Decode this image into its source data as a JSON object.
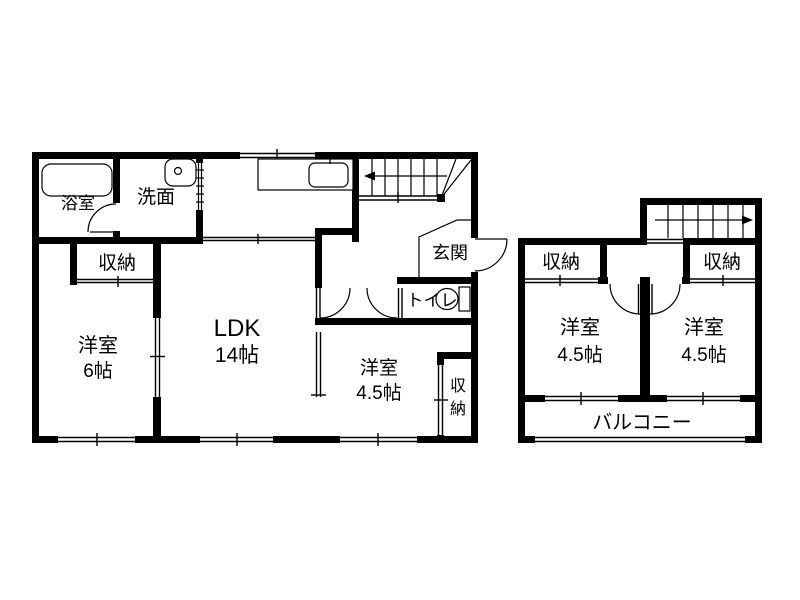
{
  "doc": {
    "type": "floor-plan",
    "floors_shown": 2
  },
  "colors": {
    "wall": "#000000",
    "background": "#ffffff",
    "text": "#000000"
  },
  "f1": {
    "bath": "浴室",
    "wash": "洗面",
    "closet_nw": "収納",
    "bed6_name": "洋室",
    "bed6_size": "6帖",
    "ldk_name": "LDK",
    "ldk_size": "14帖",
    "entrance": "玄関",
    "toilet": "トイレ",
    "bed45_name": "洋室",
    "bed45_size": "4.5帖",
    "closet_se_1": "収",
    "closet_se_2": "納"
  },
  "f2": {
    "closet_l": "収納",
    "closet_r": "収納",
    "bed_l_name": "洋室",
    "bed_l_size": "4.5帖",
    "bed_r_name": "洋室",
    "bed_r_size": "4.5帖",
    "balcony": "バルコニー"
  }
}
